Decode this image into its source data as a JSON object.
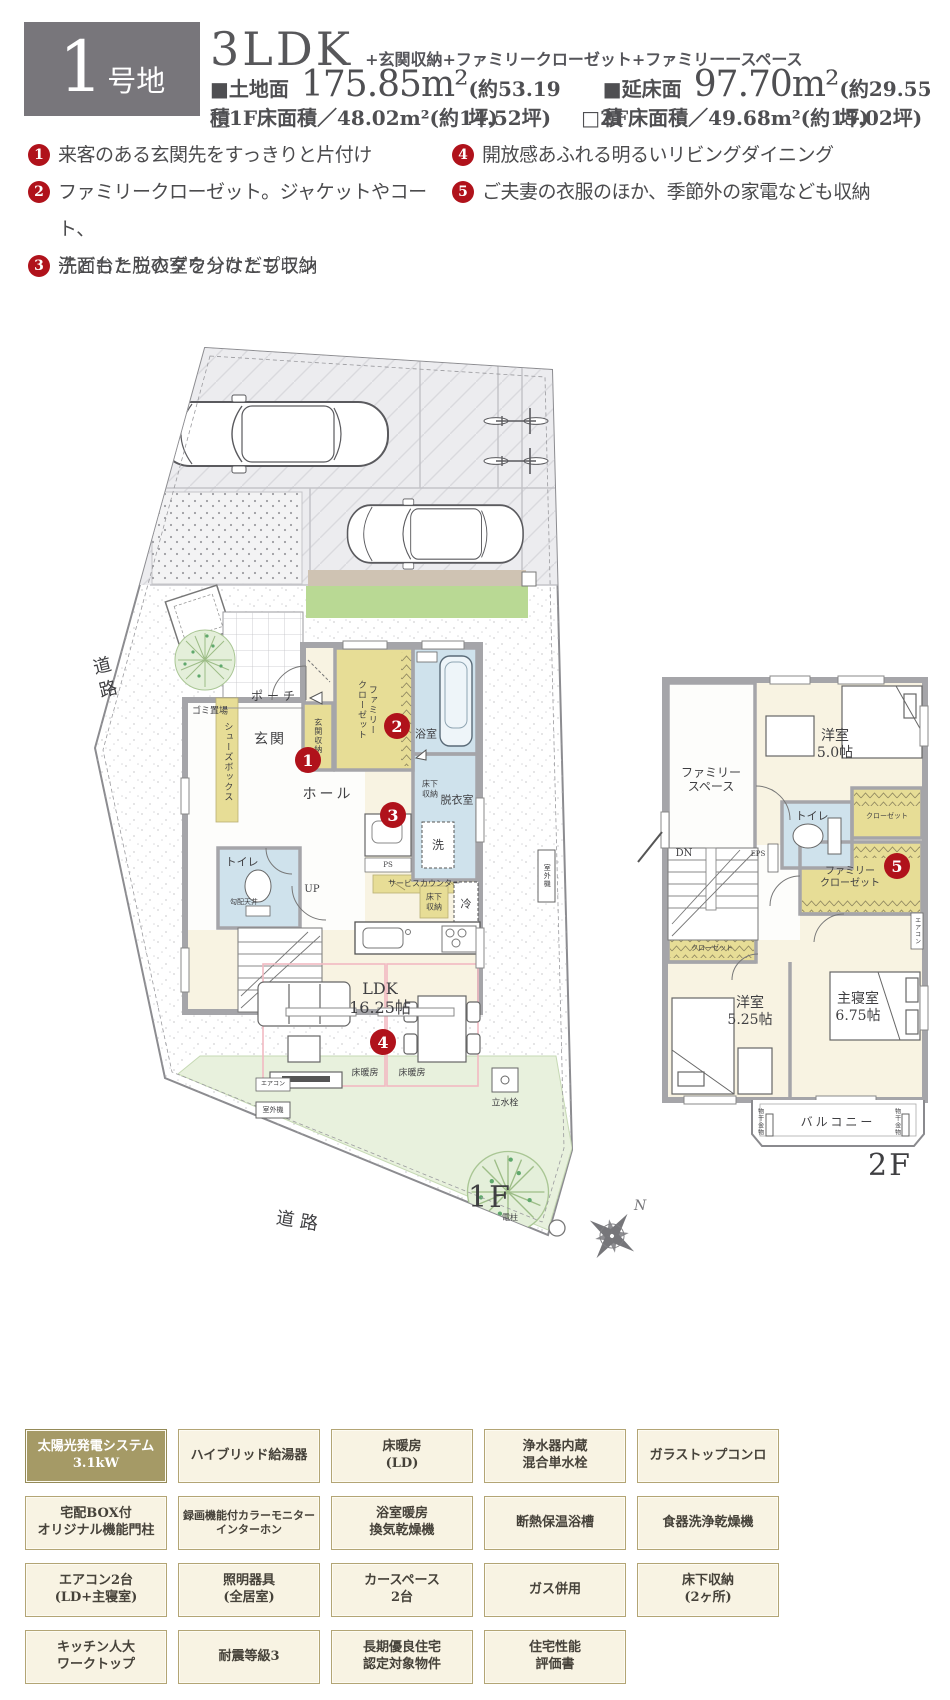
{
  "header": {
    "lot_number": "1",
    "lot_suffix": "号地",
    "plan_type": "3LDK",
    "plan_features": "+玄関収納+ファミリークローゼット+ファミリーースペース",
    "land_label": "■土地面積",
    "land_value": "175.85m²",
    "land_tsubo": "(約53.19坪)",
    "total_label": "■延床面積",
    "total_value": "97.70m²",
    "total_tsubo": "(約29.55坪)",
    "f1_area": "□1F床面積／48.02m²(約14.52坪)",
    "f2_area": "□2F床面積／49.68m²(約15.02坪)"
  },
  "features": {
    "items": [
      {
        "num": "1",
        "text": "来客のある玄関先をすっきりと片付け"
      },
      {
        "num": "2",
        "text": "ファミリークローゼット。ジャケットやコート、\n子どもたちのダウンなども収納"
      },
      {
        "num": "3",
        "text": "洗面台と脱衣室を分けたプラン"
      },
      {
        "num": "4",
        "text": "開放感あふれる明るいリビングダイニング"
      },
      {
        "num": "5",
        "text": "ご夫妻の衣服のほか、季節外の家電なども収納"
      }
    ]
  },
  "markers": {
    "n1": "1",
    "n2": "2",
    "n3": "3",
    "n4": "4",
    "n5": "5"
  },
  "plan1f": {
    "floor_label": "1F",
    "labels": {
      "road": "道路",
      "gomi": "ゴミ置場",
      "porch": "ポーチ",
      "genkan": "玄関",
      "shoes": "シューズボックス",
      "genkan_shuno": "玄関収納",
      "family_closet": "ファミリー\nクローゼット",
      "bath": "浴室",
      "yukashita": "床下\n収納",
      "datsui": "脱衣室",
      "sen": "洗",
      "toilet": "トイレ",
      "kobai": "勾配天井",
      "up": "UP",
      "hall": "ホール",
      "ps": "PS",
      "service": "サービスカウンター",
      "rei": "冷",
      "ldk": "LDK\n16.25帖",
      "yukadanbo": "床暖房",
      "aircon": "エアコン",
      "shitsugaiki": "室外機",
      "rissuisen": "立水栓",
      "denchu": "電柱"
    }
  },
  "plan2f": {
    "floor_label": "2F",
    "labels": {
      "family_space": "ファミリー\nスペース",
      "yoshitsu50": "洋室\n5.0帖",
      "toilet": "トイレ",
      "closet": "クローゼット",
      "eps": "EPS",
      "dn": "DN",
      "family_closet": "ファミリー\nクローゼット",
      "yoshitsu525": "洋室\n5.25帖",
      "shushinshitsu": "主寝室\n6.75帖",
      "aircon": "エアコン",
      "balcony": "バルコニー",
      "monohoshi": "物干金物"
    }
  },
  "compass": {
    "n": "N"
  },
  "badges": {
    "items": [
      {
        "label": "太陽光発電システム\n3.1kW"
      },
      {
        "label": "ハイブリッド給湯器"
      },
      {
        "label": "床暖房\n(LD)"
      },
      {
        "label": "浄水器内蔵\n混合単水栓"
      },
      {
        "label": "ガラストップコンロ"
      },
      {
        "label": "宅配BOX付\nオリジナル機能門柱"
      },
      {
        "label": "録画機能付カラーモニター\nインターホン"
      },
      {
        "label": "浴室暖房\n換気乾燥機"
      },
      {
        "label": "断熱保温浴槽"
      },
      {
        "label": "食器洗浄乾燥機"
      },
      {
        "label": "エアコン2台\n(LD+主寝室)"
      },
      {
        "label": "照明器具\n(全居室)"
      },
      {
        "label": "カースペース\n2台"
      },
      {
        "label": "ガス併用"
      },
      {
        "label": "床下収納\n(2ヶ所)"
      },
      {
        "label": "キッチン人大\nワークトップ"
      },
      {
        "label": "耐震等級3"
      },
      {
        "label": "長期優良住宅\n認定対象物件"
      },
      {
        "label": "住宅性能\n評価書"
      }
    ]
  },
  "colors": {
    "accent_red": "#b0121b",
    "badge_olive": "#a59a66",
    "wall_gray": "#a5a5a9",
    "room_cream": "#f8f3e2",
    "closet_khaki": "#e7dd96",
    "wet_blue": "#cfe2ec",
    "lawn_green": "#e8f1dd",
    "hedge_green": "#b9d994"
  }
}
